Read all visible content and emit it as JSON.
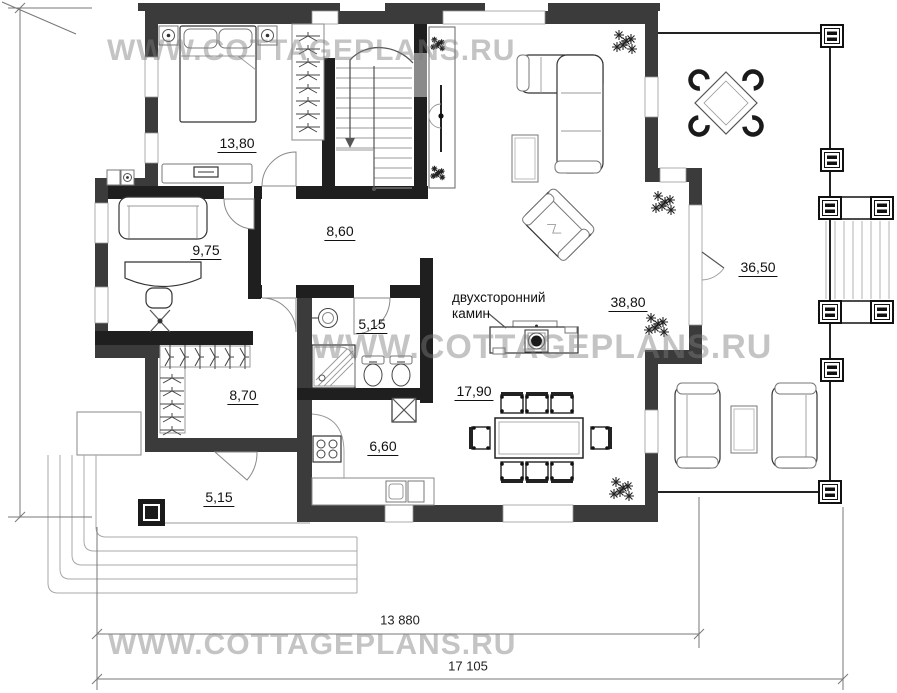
{
  "watermark": {
    "url_text": "WWW.COTTAGEPLANS.RU"
  },
  "rooms": {
    "bedroom": {
      "area": "13,80"
    },
    "study": {
      "area": "9,75"
    },
    "hall": {
      "area": "8,60"
    },
    "bathroom": {
      "area": "5,15"
    },
    "corridor": {
      "area": "8,70"
    },
    "porch": {
      "area": "5,15"
    },
    "kitchen": {
      "area": "6,60"
    },
    "dining": {
      "area": "17,90"
    },
    "living": {
      "area": "38,80"
    },
    "terrace": {
      "area": "36,50"
    }
  },
  "annotations": {
    "fireplace": {
      "line1": "двухсторонний",
      "line2": "камин"
    }
  },
  "dimensions": {
    "height_total": "11 860",
    "width_inner": "13 880",
    "width_total": "17 105"
  },
  "colors": {
    "wall_exterior": "#3b3b3b",
    "wall_interior": "#1f1f1f",
    "watermark_gray": "#9a9a9a",
    "background": "#ffffff"
  }
}
